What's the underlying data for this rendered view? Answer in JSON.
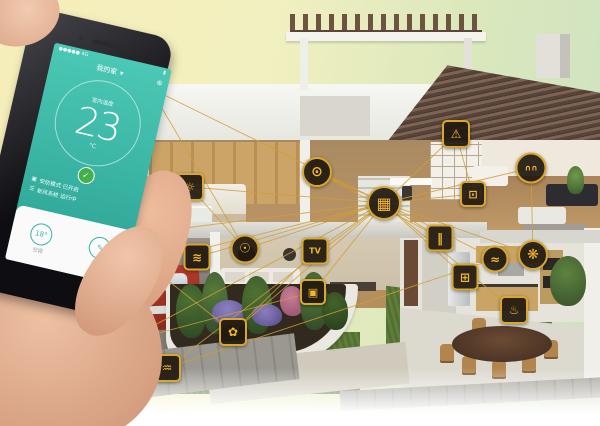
{
  "phone": {
    "status_left": "●●●●● 4G",
    "status_right": "▮",
    "title": "我的家",
    "title_caret": "▾",
    "nav_action": "⊕",
    "temp_label": "室内温度",
    "temp_value": "23",
    "temp_unit": "°C",
    "shield_glyph": "✓",
    "row1_icon": "▣",
    "row1_text": "安防模式 已开启",
    "row2_icon": "☰",
    "row2_text": "新风系统 运行中",
    "tool1_value": "18°",
    "tool1_label": "空调",
    "tool2_value": "✎",
    "tool2_label": "编辑"
  },
  "colors": {
    "accent": "#f4b62d",
    "line": "#cf9f35",
    "screen_teal": "#35b7a6",
    "shield_green": "#43b04a"
  },
  "devices": [
    {
      "id": "wifi-point",
      "name": "wifi-signal-anchor",
      "glyph": "",
      "x": 150,
      "y": 88,
      "shape": "none"
    },
    {
      "id": "hub",
      "name": "smart-hub",
      "glyph": "▦",
      "x": 384,
      "y": 203,
      "shape": "circle",
      "size": 30
    },
    {
      "id": "camera",
      "name": "security-camera",
      "glyph": "◉",
      "x": 113,
      "y": 237,
      "shape": "circle",
      "size": 22
    },
    {
      "id": "power-plug",
      "name": "power-plug",
      "glyph": "ϟ",
      "x": 50,
      "y": 287,
      "shape": "square",
      "size": 23
    },
    {
      "id": "garage-door",
      "name": "garage-door",
      "glyph": "▤",
      "x": 121,
      "y": 343,
      "shape": "square",
      "size": 24,
      "variant": "gold"
    },
    {
      "id": "motion-sensor",
      "name": "motion-sensor",
      "glyph": "♒",
      "x": 167,
      "y": 368,
      "shape": "square",
      "size": 24
    },
    {
      "id": "irrigation",
      "name": "garden-irrigation",
      "glyph": "✿",
      "x": 233,
      "y": 332,
      "shape": "square",
      "size": 24
    },
    {
      "id": "wall-switch",
      "name": "wall-switch",
      "glyph": "▣",
      "x": 313,
      "y": 292,
      "shape": "square",
      "size": 22
    },
    {
      "id": "air-conditioner",
      "name": "air-conditioner",
      "glyph": "≋",
      "x": 197,
      "y": 257,
      "shape": "square",
      "size": 23
    },
    {
      "id": "light-bulb",
      "name": "smart-light",
      "glyph": "☉",
      "x": 245,
      "y": 249,
      "shape": "circle",
      "size": 25
    },
    {
      "id": "tv",
      "name": "smart-tv",
      "glyph": "TV",
      "x": 315,
      "y": 251,
      "shape": "square",
      "size": 23
    },
    {
      "id": "heater",
      "name": "bedroom-thermostat",
      "glyph": "☼",
      "x": 190,
      "y": 187,
      "shape": "square",
      "size": 24
    },
    {
      "id": "washing-machine",
      "name": "washing-machine",
      "glyph": "⊙",
      "x": 317,
      "y": 172,
      "shape": "circle",
      "size": 26
    },
    {
      "id": "window-sensor",
      "name": "window-sensor",
      "glyph": "‖",
      "x": 440,
      "y": 238,
      "shape": "square",
      "size": 23
    },
    {
      "id": "alarm",
      "name": "roof-alarm",
      "glyph": "⚠",
      "x": 456,
      "y": 134,
      "shape": "square",
      "size": 24
    },
    {
      "id": "socket",
      "name": "bedroom-socket",
      "glyph": "⊡",
      "x": 473,
      "y": 194,
      "shape": "square",
      "size": 22
    },
    {
      "id": "curtain",
      "name": "smart-curtain",
      "glyph": "∩∩",
      "x": 531,
      "y": 168,
      "shape": "circle",
      "size": 27
    },
    {
      "id": "faucet",
      "name": "kitchen-faucet",
      "glyph": "≈",
      "x": 495,
      "y": 259,
      "shape": "circle",
      "size": 23
    },
    {
      "id": "exhaust-fan",
      "name": "exhaust-fan",
      "glyph": "❋",
      "x": 533,
      "y": 255,
      "shape": "circle",
      "size": 26
    },
    {
      "id": "dishwasher",
      "name": "dishwasher",
      "glyph": "⊞",
      "x": 465,
      "y": 277,
      "shape": "square",
      "size": 23
    },
    {
      "id": "stove",
      "name": "smart-stove",
      "glyph": "♨",
      "x": 514,
      "y": 310,
      "shape": "square",
      "size": 24
    }
  ],
  "connections": [
    [
      "hub",
      "camera"
    ],
    [
      "hub",
      "power-plug"
    ],
    [
      "hub",
      "garage-door"
    ],
    [
      "hub",
      "motion-sensor"
    ],
    [
      "hub",
      "irrigation"
    ],
    [
      "hub",
      "wall-switch"
    ],
    [
      "hub",
      "air-conditioner"
    ],
    [
      "hub",
      "light-bulb"
    ],
    [
      "hub",
      "tv"
    ],
    [
      "hub",
      "heater"
    ],
    [
      "hub",
      "washing-machine"
    ],
    [
      "hub",
      "window-sensor"
    ],
    [
      "hub",
      "alarm"
    ],
    [
      "hub",
      "socket"
    ],
    [
      "hub",
      "curtain"
    ],
    [
      "hub",
      "faucet"
    ],
    [
      "hub",
      "exhaust-fan"
    ],
    [
      "hub",
      "dishwasher"
    ],
    [
      "hub",
      "stove"
    ],
    [
      "hub",
      "wifi-point"
    ],
    [
      "camera",
      "irrigation"
    ],
    [
      "power-plug",
      "motion-sensor"
    ],
    [
      "garage-door",
      "wall-switch"
    ],
    [
      "washing-machine",
      "window-sensor"
    ],
    [
      "heater",
      "light-bulb"
    ],
    [
      "alarm",
      "socket"
    ],
    [
      "curtain",
      "exhaust-fan"
    ],
    [
      "motion-sensor",
      "faucet"
    ],
    [
      "irrigation",
      "tv"
    ],
    [
      "wifi-point",
      "light-bulb"
    ]
  ]
}
